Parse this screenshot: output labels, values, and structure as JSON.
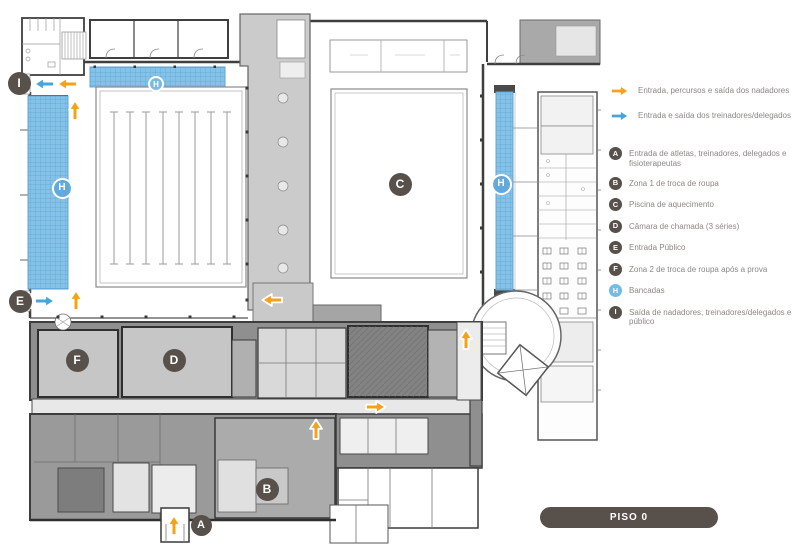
{
  "floor_badge": {
    "label": "PISO 0"
  },
  "legend": {
    "flow_items": [
      {
        "label": "Entrada, percursos e saída dos nadadores",
        "color": "#F5A11C",
        "icon": "arrow-right"
      },
      {
        "label": "Entrada e saída dos treinadores/delegados",
        "color": "#46A5DC",
        "icon": "arrow-right"
      }
    ],
    "marker_items": [
      {
        "letter": "A",
        "color": "#57504B",
        "label": "Entrada de atletas, treinadores, delegados e fisioterapeutas"
      },
      {
        "letter": "B",
        "color": "#57504B",
        "label": "Zona 1 de troca de roupa"
      },
      {
        "letter": "C",
        "color": "#57504B",
        "label": "Piscina de aquecimento"
      },
      {
        "letter": "D",
        "color": "#57504B",
        "label": "Câmara de chamada (3 séries)"
      },
      {
        "letter": "E",
        "color": "#57504B",
        "label": "Entrada Público"
      },
      {
        "letter": "F",
        "color": "#57504B",
        "label": "Zona 2 de troca de roupa após a prova"
      },
      {
        "letter": "H",
        "color": "#75BCE5",
        "label": "Bancadas"
      },
      {
        "letter": "I",
        "color": "#57504B",
        "label": "Saída de nadadores, treinadores/delegados e público"
      }
    ]
  },
  "plan": {
    "markers": [
      {
        "letter": "I",
        "type": "dark"
      },
      {
        "letter": "H",
        "type": "stands"
      },
      {
        "letter": "H",
        "type": "stands"
      },
      {
        "letter": "E",
        "type": "dark"
      },
      {
        "letter": "F",
        "type": "dark"
      },
      {
        "letter": "D",
        "type": "dark"
      },
      {
        "letter": "C",
        "type": "dark"
      },
      {
        "letter": "H",
        "type": "stands"
      },
      {
        "letter": "B",
        "type": "dark"
      },
      {
        "letter": "A",
        "type": "dark"
      }
    ],
    "flow_arrows": [
      {
        "color": "orange",
        "direction": "left"
      },
      {
        "color": "orange",
        "direction": "up"
      },
      {
        "color": "orange",
        "direction": "up"
      },
      {
        "color": "orange",
        "direction": "left"
      },
      {
        "color": "orange",
        "direction": "up"
      },
      {
        "color": "orange",
        "direction": "up"
      },
      {
        "color": "orange",
        "direction": "right"
      },
      {
        "color": "orange",
        "direction": "up"
      },
      {
        "color": "blue",
        "direction": "left"
      },
      {
        "color": "blue",
        "direction": "right"
      }
    ]
  },
  "colors": {
    "flow_swimmers": "#F5A11C",
    "flow_coaches": "#46A5DC",
    "marker_dark": "#57504B",
    "marker_stands": "#75BCE5",
    "stands_fill": "#8CC5EA",
    "badge": "#57504B",
    "legend_text": "#8D8883"
  }
}
